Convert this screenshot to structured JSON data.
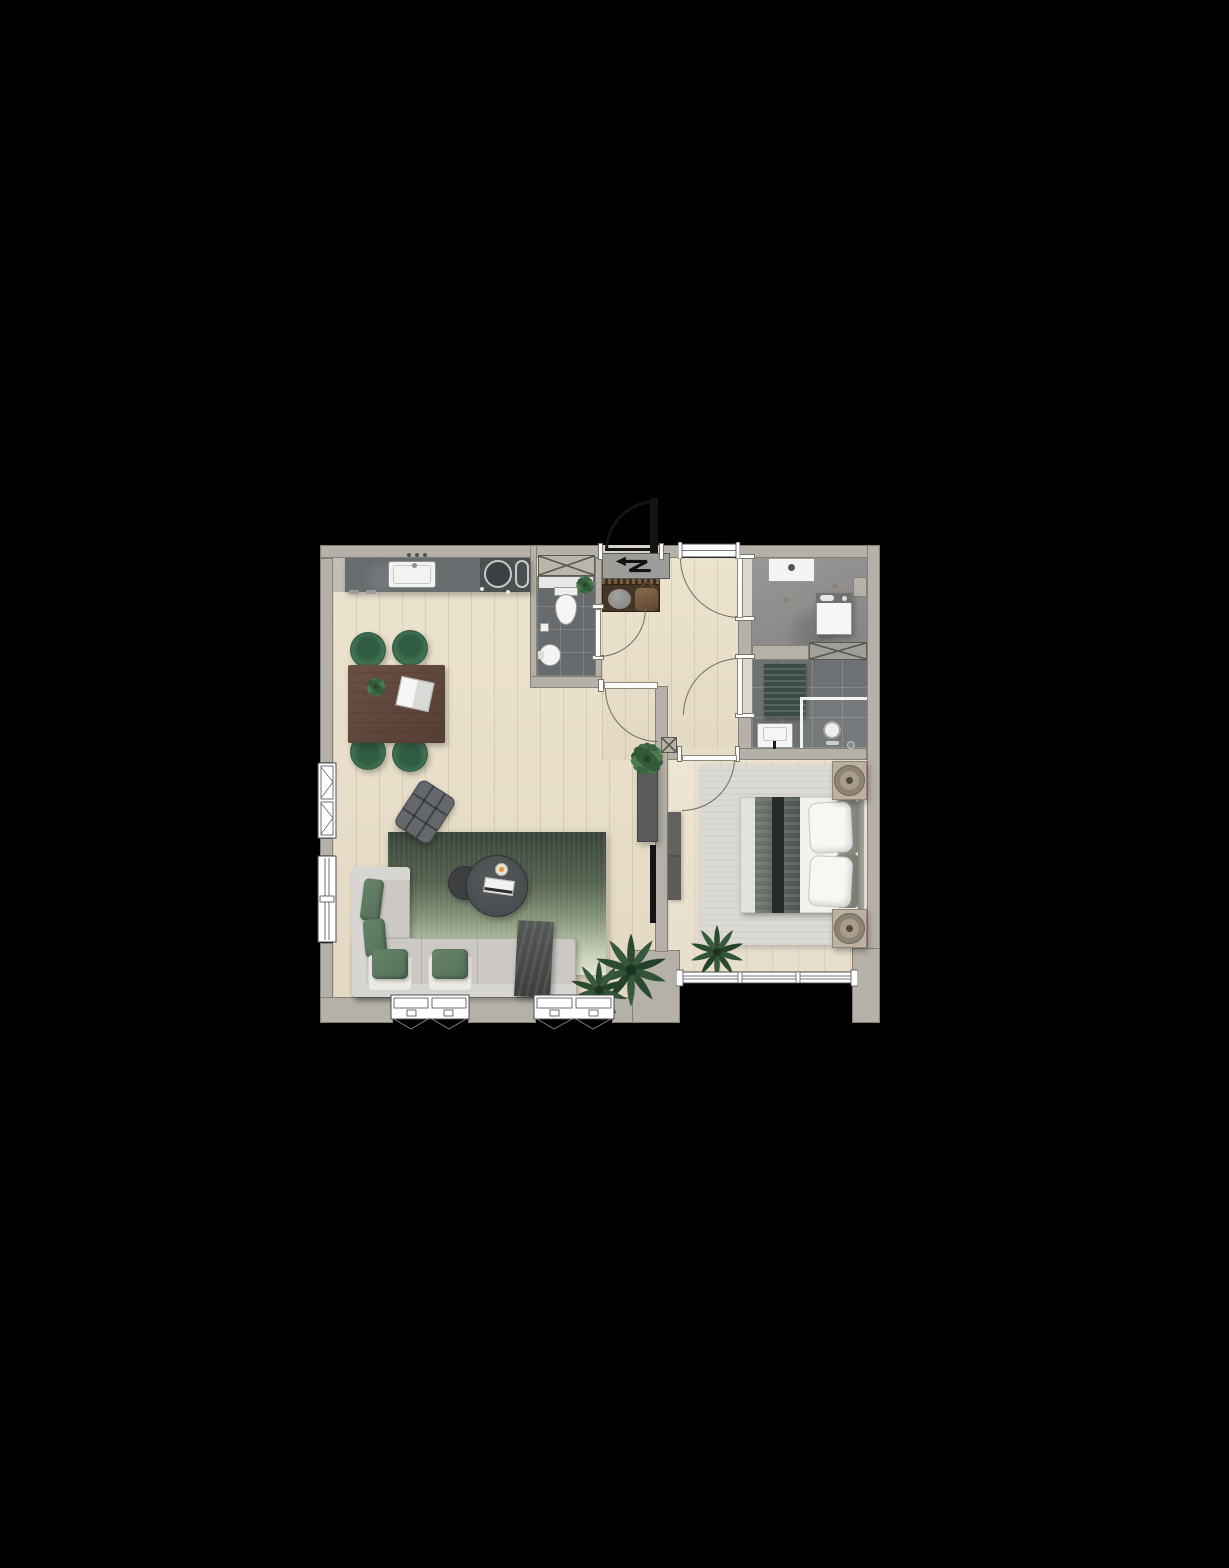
{
  "scene": {
    "kind": "architectural floor plan, top-down 3D render of a one-bedroom apartment",
    "background": "#000000"
  },
  "palette": {
    "walls": "#b5b1a8",
    "wood_floor": "#e9e0cc",
    "dark_tile": "#6e7173",
    "concrete_floor": "#8f8e8b",
    "kitchen_counter": "#4e5254",
    "sofa_gray": "#ccc9c4",
    "accent_green": "#5e7a60",
    "living_rug_top": "#39443a",
    "living_rug_bottom": "#dfe3cf",
    "bedroom_rug": "#dbdad5",
    "bed_white": "#f2f1ed",
    "table_wood": "#5d4539",
    "entrance_door_black": "#141414",
    "door_swing_arc": "#716e66",
    "meter_panel": "#9c9c99"
  },
  "rooms": {
    "living_kitchen": {
      "label": "open living room with kitchen",
      "floor": "wood"
    },
    "hallway": {
      "label": "entrance hall",
      "floor": "wood"
    },
    "toilet": {
      "label": "toilet room",
      "floor": "dark tile"
    },
    "utility": {
      "label": "utility room",
      "floor": "concrete"
    },
    "bathroom": {
      "label": "bathroom",
      "floor": "dark tile"
    },
    "bedroom": {
      "label": "bedroom",
      "floor": "wood"
    }
  },
  "symbols": {
    "meter_cupboard": "zigzag-arrow",
    "shafts": "crossed-box x2",
    "column": "crossed-box",
    "door_swings": "quarter-arc x6",
    "windows": [
      "casement-left-wall",
      "fixed-left-wall",
      "casement-bottom x2",
      "fixed-top-hall",
      "sliding-bedroom-3-pane"
    ],
    "fixtures": [
      "kitchen-sink",
      "round-hob",
      "toilet",
      "hand-basin",
      "toilet-paper-holder",
      "utility-sink",
      "washing-machine",
      "bath-mat",
      "bathroom-sink",
      "shower-screen",
      "shower-head",
      "drain"
    ],
    "furniture": [
      "dining-table",
      "dining-chair x4",
      "corner-sofa",
      "green-pillow x4",
      "throw-blanket",
      "coffee-table x2",
      "books",
      "candle",
      "lounge-chair",
      "tv-cabinet",
      "tv",
      "double-bed",
      "bed-throw",
      "pillow x2",
      "nightstand x2",
      "table-lamp x2",
      "dresser",
      "coat-rack",
      "pouf",
      "hand-bag"
    ],
    "plants": [
      "floor-palm x2",
      "bedroom-palm",
      "dining-table-plant",
      "toilet-plant",
      "tv-cabinet-plant"
    ]
  }
}
